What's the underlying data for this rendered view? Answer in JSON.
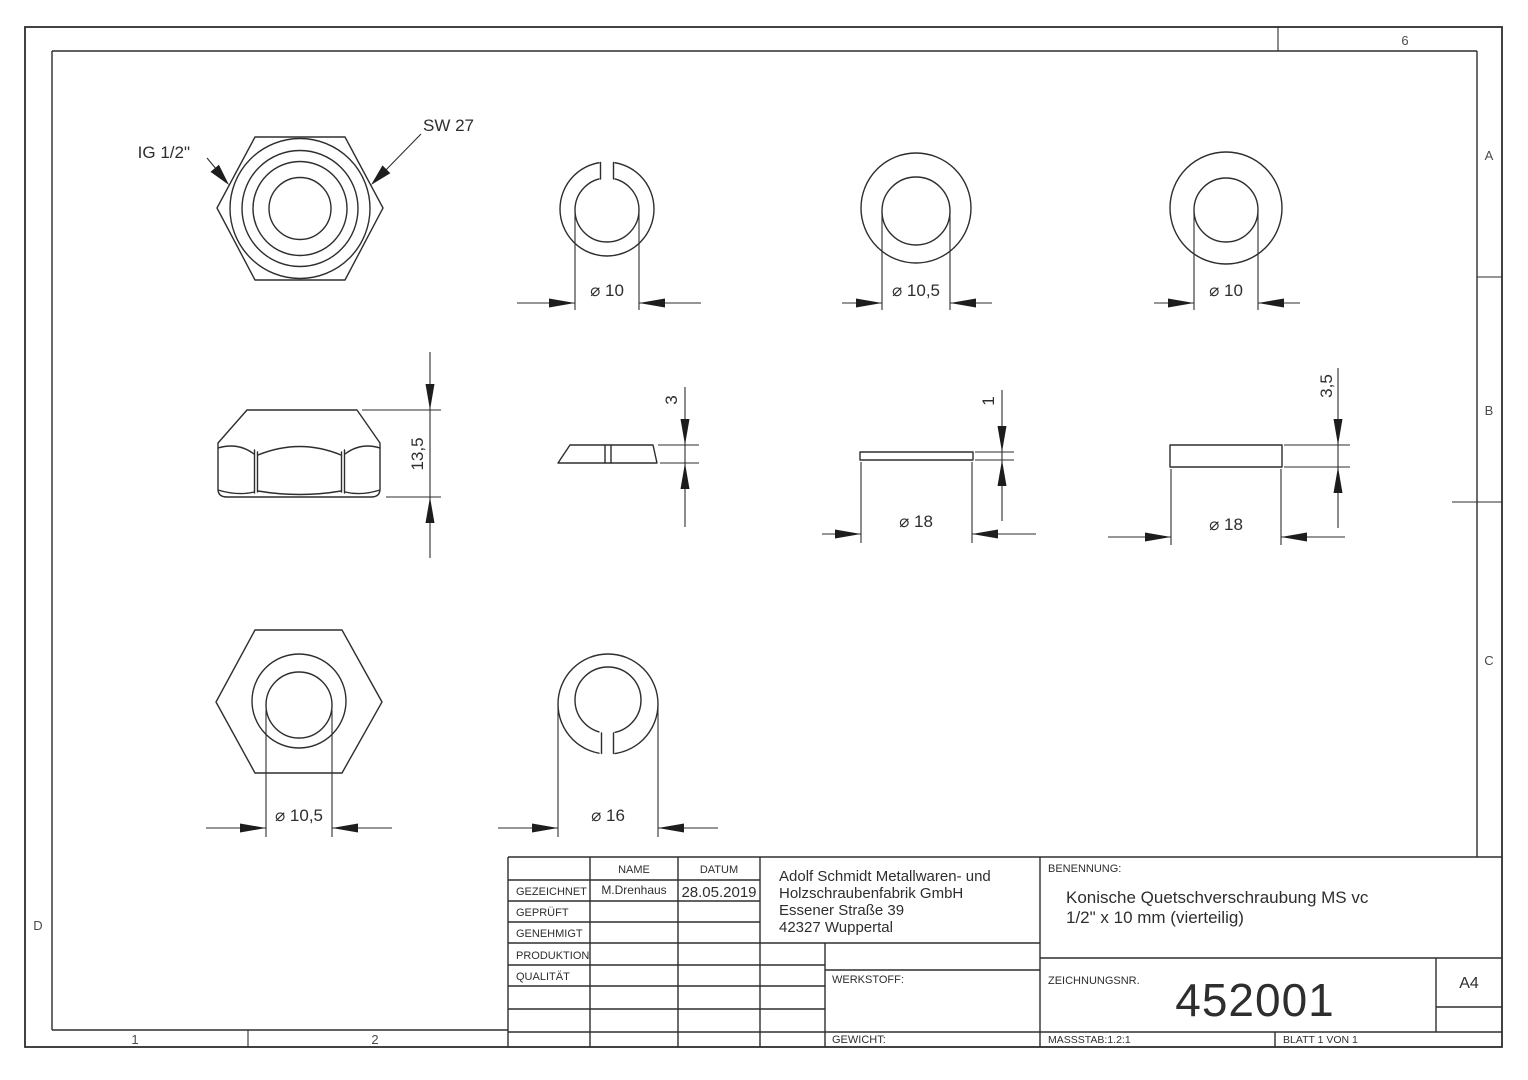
{
  "colors": {
    "ink": "#2e2e2e",
    "background": "#ffffff"
  },
  "frame": {
    "zone_top": "6",
    "zone_a": "A",
    "zone_b": "B",
    "zone_c": "C",
    "zone_d": "D",
    "zone_1": "1",
    "zone_2": "2"
  },
  "labels": {
    "thread": "IG 1/2\"",
    "wrench": "SW 27"
  },
  "dims": {
    "clamp_ring_bore": "⌀ 10",
    "ring_bore_105": "⌀ 10,5",
    "ring_bore_10": "⌀ 10",
    "nut_height": "13,5",
    "clamp_ring_thickness": "3",
    "washer_thin_thickness": "1",
    "washer_thin_dia": "⌀ 18",
    "washer_thick_thickness": "3,5",
    "washer_thick_dia": "⌀ 18",
    "nut_bore": "⌀ 10,5",
    "clamp_ring_outer": "⌀ 16"
  },
  "titleblock": {
    "col_name": "NAME",
    "col_datum": "DATUM",
    "rows": [
      {
        "label": "GEZEICHNET",
        "name": "M.Drenhaus",
        "datum": "28.05.2019"
      },
      {
        "label": "GEPRÜFT",
        "name": "",
        "datum": ""
      },
      {
        "label": "GENEHMIGT",
        "name": "",
        "datum": ""
      },
      {
        "label": "PRODUKTION",
        "name": "",
        "datum": ""
      },
      {
        "label": "QUALITÄT",
        "name": "",
        "datum": ""
      }
    ],
    "company": [
      "Adolf Schmidt Metallwaren- und",
      "Holzschraubenfabrik GmbH",
      "Essener Straße 39",
      "42327 Wuppertal"
    ],
    "benennung_label": "BENENNUNG:",
    "title_line1": "Konische Quetschverschraubung MS vc",
    "title_line2": "1/2\" x 10 mm (vierteilig)",
    "werkstoff_label": "WERKSTOFF:",
    "gewicht_label": "GEWICHT:",
    "zeichnungsnr_label": "ZEICHNUNGSNR.",
    "zeichnungsnr": "452001",
    "format": "A4",
    "massstab": "MASSSTAB:1.2:1",
    "blatt": "BLATT 1 VON 1"
  }
}
